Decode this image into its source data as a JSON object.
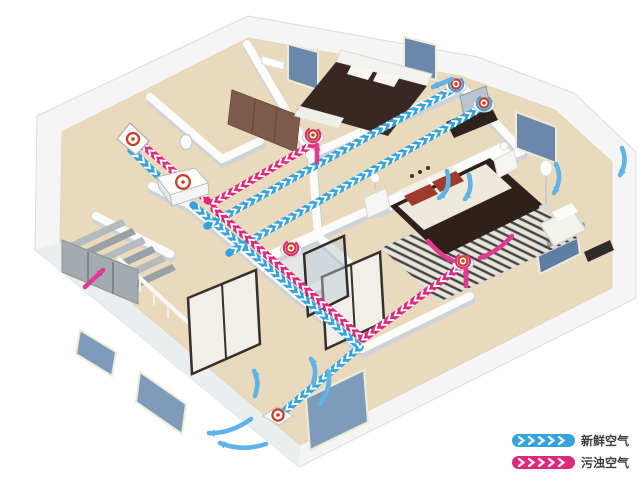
{
  "diagram": {
    "kind": "home-fresh-air-ventilation-3d-floorplan",
    "colors": {
      "fresh": "#35a3dc",
      "polluted": "#de2a7d",
      "fresh-arrow": "#5fb3e6",
      "polluted-arrow": "#e23a90",
      "vent-ring": "#c8402a",
      "chevron": "#ffffff",
      "floor": "#eadabd",
      "wall": "#fbfbf9",
      "wall-shadow": "#cdd3d6",
      "legend-text": "#3c3c3c"
    },
    "legend": {
      "items": [
        {
          "id": "fresh-air",
          "label": "新鲜空气"
        },
        {
          "id": "polluted-air",
          "label": "污浊空气"
        }
      ]
    },
    "ducts": [
      {
        "flow": "fresh",
        "name": "outdoor-intake",
        "points": [
          [
            131,
            150
          ],
          [
            180,
            197
          ]
        ]
      },
      {
        "flow": "fresh",
        "name": "supply-trunk-living-room",
        "points": [
          [
            193,
            205
          ],
          [
            262,
            262
          ],
          [
            360,
            347
          ],
          [
            281,
            414
          ]
        ]
      },
      {
        "flow": "fresh",
        "name": "supply-branch-bedroom-1",
        "points": [
          [
            207,
            226
          ],
          [
            455,
            88
          ]
        ]
      },
      {
        "flow": "fresh",
        "name": "supply-branch-master-bedroom",
        "points": [
          [
            229,
            253
          ],
          [
            484,
            106
          ]
        ]
      },
      {
        "flow": "polluted",
        "name": "exhaust-to-outdoor",
        "points": [
          [
            208,
            201
          ],
          [
            138,
            141
          ]
        ]
      },
      {
        "flow": "polluted",
        "name": "return-branch-hall",
        "points": [
          [
            313,
            144
          ],
          [
            213,
            203
          ]
        ]
      },
      {
        "flow": "polluted",
        "name": "return-trunk",
        "points": [
          [
            363,
            339
          ],
          [
            214,
            209
          ]
        ]
      },
      {
        "flow": "polluted",
        "name": "return-branch-master-bedroom",
        "points": [
          [
            461,
            266
          ],
          [
            363,
            339
          ]
        ]
      }
    ],
    "vents": [
      {
        "kind": "wall",
        "name": "outdoor-wall-vent",
        "x": 133,
        "y": 140
      },
      {
        "kind": "unit",
        "name": "heat-recovery-ventilation-unit",
        "x": 182,
        "y": 188
      },
      {
        "kind": "supply",
        "name": "supply-diffuser-bedroom-1",
        "x": 456,
        "y": 84
      },
      {
        "kind": "supply",
        "name": "supply-diffuser-master-bedroom",
        "x": 484,
        "y": 103
      },
      {
        "kind": "floor",
        "name": "supply-diffuser-living-room",
        "x": 278,
        "y": 415
      },
      {
        "kind": "extract",
        "name": "extract-diffuser-hall",
        "x": 313,
        "y": 135
      },
      {
        "kind": "extract",
        "name": "extract-diffuser-bathroom",
        "x": 291,
        "y": 248
      },
      {
        "kind": "extract",
        "name": "extract-diffuser-master-bedroom",
        "x": 463,
        "y": 261
      }
    ],
    "airflow_arrows": [
      {
        "color": "fresh",
        "name": "bedroom1-inflow",
        "d": "M452,79 L433,87"
      },
      {
        "color": "fresh",
        "name": "master-inflow-1",
        "d": "M447,171 Q452,189 439,198"
      },
      {
        "color": "fresh",
        "name": "master-inflow-2",
        "d": "M469,175 Q473,190 465,199"
      },
      {
        "color": "fresh",
        "name": "master-circulation-1",
        "d": "M556,164 Q563,179 554,193"
      },
      {
        "color": "fresh",
        "name": "master-circulation-2",
        "d": "M622,148 Q628,162 620,175"
      },
      {
        "color": "fresh",
        "name": "living-circulation-1",
        "d": "M255,396 Q260,382 254,371"
      },
      {
        "color": "fresh",
        "name": "living-circulation-2",
        "d": "M313,383 Q318,369 311,359"
      },
      {
        "color": "fresh",
        "name": "living-circulation-3",
        "d": "M251,419 Q230,434 209,433"
      },
      {
        "color": "fresh",
        "name": "living-circulation-4",
        "d": "M266,444 Q242,452 220,443"
      },
      {
        "color": "fresh",
        "name": "living-circulation-5",
        "d": "M320,404 Q332,387 328,371"
      },
      {
        "color": "polluted",
        "name": "stairs-updraft",
        "d": "M85,287 L103,270"
      },
      {
        "color": "polluted",
        "name": "master-outflow-1",
        "d": "M428,241 Q441,256 453,261"
      },
      {
        "color": "polluted",
        "name": "master-outflow-2",
        "d": "M512,236 Q497,252 480,258"
      },
      {
        "color": "polluted",
        "name": "hall-extract-up",
        "d": "M317,162 L317,145"
      },
      {
        "color": "polluted",
        "name": "master-extract-up",
        "d": "M466,286 L466,269"
      }
    ]
  }
}
